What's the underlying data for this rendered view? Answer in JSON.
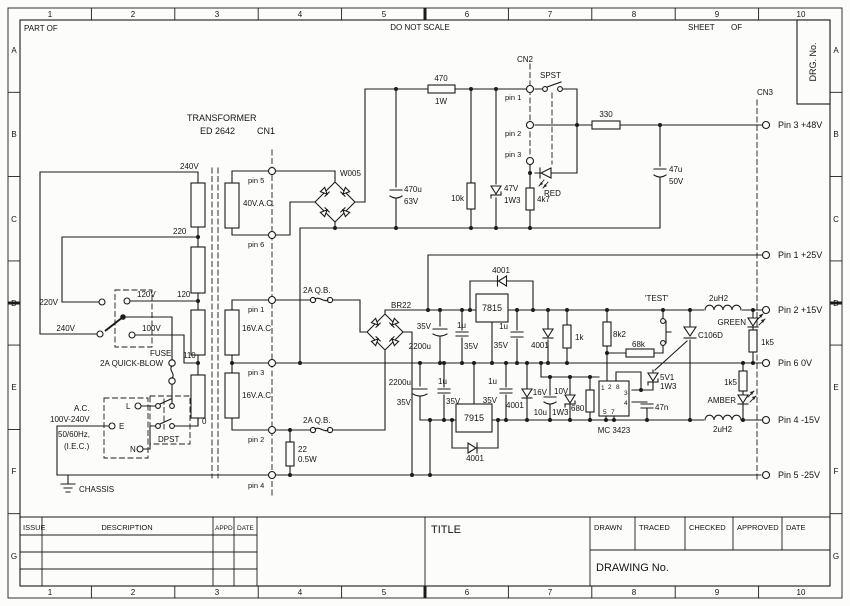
{
  "frame": {
    "part_of": "PART OF",
    "do_not_scale": "DO NOT SCALE",
    "sheet": "SHEET",
    "of": "OF",
    "drg_no": "DRG. No.",
    "cols": [
      "1",
      "2",
      "3",
      "4",
      "5",
      "6",
      "7",
      "8",
      "9",
      "10"
    ],
    "rows": [
      "A",
      "B",
      "C",
      "D",
      "E",
      "F",
      "G"
    ]
  },
  "title_block": {
    "issue": "ISSUE",
    "description": "DESCRIPTION",
    "appd": "APPD",
    "date": "DATE",
    "title": "TITLE",
    "drawn": "DRAWN",
    "traced": "TRACED",
    "checked": "CHECKED",
    "approved": "APPROVED",
    "date2": "DATE",
    "drawing_no": "DRAWING No."
  },
  "schematic": {
    "transformer": "TRANSFORMER",
    "transformer_model": "ED 2642",
    "cn1": "CN1",
    "cn2": "CN2",
    "cn3": "CN3",
    "tap_240": "240V",
    "tap_220": "220",
    "tap_120": "120",
    "tap_110": "110",
    "tap_0": "0",
    "sel_220": "220V",
    "sel_240": "240V",
    "sel_120": "120V",
    "sel_100": "100V",
    "fuse": "FUSE",
    "fuse_rating": "2A QUICK-BLOW",
    "ac": "A.C.",
    "ac_range": "100V-240V",
    "ac_freq": "50/60Hz,",
    "ac_std": "(I.E.C.)",
    "live": "L",
    "earth": "E",
    "neutral": "N",
    "dpst": "DPST",
    "chassis": "CHASSIS",
    "w40": "40V.A.C.",
    "w16": "16V.A.C.",
    "pin1": "pin 1",
    "pin2": "pin 2",
    "pin3": "pin 3",
    "pin4": "pin 4",
    "pin5": "pin 5",
    "pin6": "pin 6",
    "w005": "W005",
    "br22": "BR22",
    "r470": "470",
    "w1": "1W",
    "c470u": "470u",
    "v63": "63V",
    "r10k": "10k",
    "z47v": "47V",
    "w1_3": "1W3",
    "r4k7": "4k7",
    "r330": "330",
    "c47u": "47u",
    "v50": "50V",
    "spst": "SPST",
    "red": "RED",
    "fuse_qb": "2A Q.B.",
    "r22": "22",
    "r22_w": "0.5W",
    "c2200u": "2200u",
    "v35": "35V",
    "c1u": "1u",
    "reg_pos": "7815",
    "reg_neg": "7915",
    "d4001": "4001",
    "r1k": "1k",
    "r8k2": "8k2",
    "r68k": "68k",
    "test": "'TEST'",
    "scr": "C106D",
    "l2uh2": "2uH2",
    "green": "GREEN",
    "amber": "AMBER",
    "r1k5": "1k5",
    "z5v1": "5V1",
    "c47n": "47n",
    "c10u": "10u",
    "v16": "16V",
    "z10v": "10V",
    "r680": "680",
    "mc3423": "MC 3423",
    "mc_p1": "1",
    "mc_p2": "2",
    "mc_p8": "8",
    "mc_p3": "3",
    "mc_p4": "4",
    "mc_p5": "5",
    "mc_p7": "7",
    "out_48": "Pin 3 +48V",
    "out_25": "Pin 1 +25V",
    "out_15": "Pin 2 +15V",
    "out_0": "Pin 6 0V",
    "out_m15": "Pin 4 -15V",
    "out_m25": "Pin 5 -25V"
  }
}
